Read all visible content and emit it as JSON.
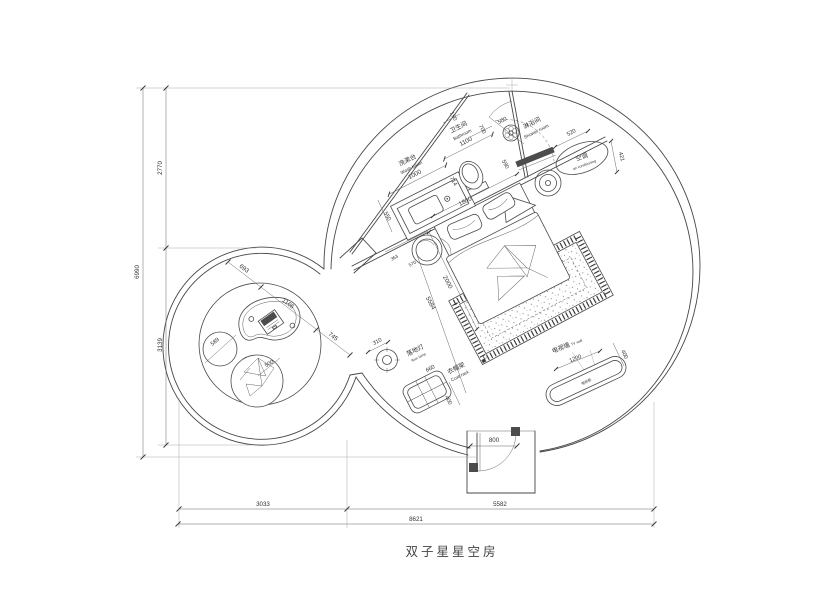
{
  "title": "双子星星空房",
  "labels": {
    "washbasin_zh": "洗漱台",
    "washbasin_en": "Wash basin",
    "bathroom_zh": "卫生间",
    "bathroom_en": "Bathroom",
    "shower_zh": "淋浴间",
    "shower_en": "Shower room",
    "ac_zh": "空调",
    "ac_en": "air conditioning",
    "lamp_zh": "落地灯",
    "lamp_en": "floor lamp",
    "rack_zh": "衣帽架",
    "rack_en": "Coat rack",
    "tv_zh": "电视墙",
    "tv_en": "TV wall",
    "tv_cabinet": "电视柜"
  },
  "dims": {
    "left_upper": "2770",
    "left_total": "6990",
    "left_lower": "3139",
    "bottom_left": "3033",
    "bottom_right": "5582",
    "bottom_total": "8621",
    "washbasin": "1000",
    "bathroom": "1100",
    "d190": "190",
    "d700": "700",
    "door_bath": "500",
    "d590": "590",
    "d520": "520",
    "d421": "421",
    "d714": "714",
    "d550": "550",
    "bed_w": "1800",
    "bed_l": "2000",
    "room_diag": "5584",
    "d363": "363",
    "d570": "570",
    "lamp": "310",
    "rack_w": "660",
    "rack_d": "400",
    "tv_w": "1200",
    "tv_d": "400",
    "door_main": "800",
    "lounge_a": "693",
    "lounge_b": "1166",
    "lounge_c": "745",
    "pouf": "589",
    "chair": "500"
  },
  "colors": {
    "line": "#474747",
    "dark_fill": "#4c4c4c",
    "background": "#ffffff"
  }
}
